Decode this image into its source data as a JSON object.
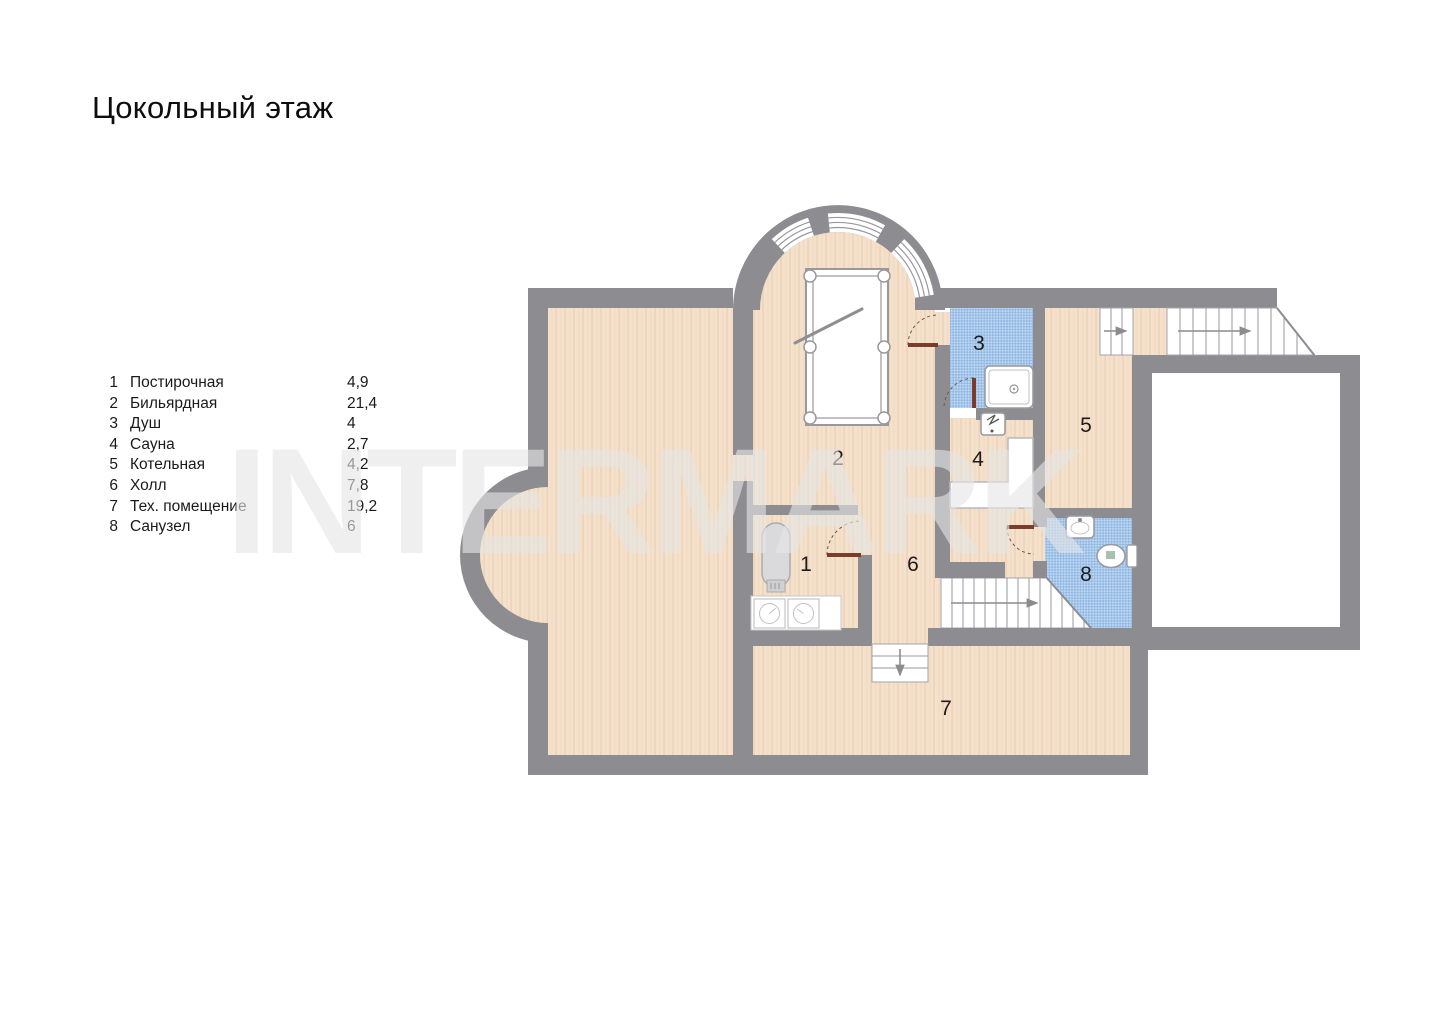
{
  "title": "Цокольный этаж",
  "watermark": "INTERMARK",
  "legend": {
    "items": [
      {
        "num": "1",
        "name": "Постирочная",
        "area": "4,9"
      },
      {
        "num": "2",
        "name": "Бильярдная",
        "area": "21,4"
      },
      {
        "num": "3",
        "name": "Душ",
        "area": "4"
      },
      {
        "num": "4",
        "name": "Сауна",
        "area": "2,7"
      },
      {
        "num": "5",
        "name": "Котельная",
        "area": "4,2"
      },
      {
        "num": "6",
        "name": "Холл",
        "area": "7,8"
      },
      {
        "num": "7",
        "name": "Тех. помещение",
        "area": "19,2"
      },
      {
        "num": "8",
        "name": "Санузел",
        "area": "6"
      }
    ]
  },
  "colors": {
    "wall": "#8d8d91",
    "floor": "#f5e1cb",
    "floor_stripe": "#e7cdaf",
    "tile_blue": "#8fb8e4",
    "door_leaf": "#7a3d2b",
    "watermark": "#e5e5e5"
  }
}
